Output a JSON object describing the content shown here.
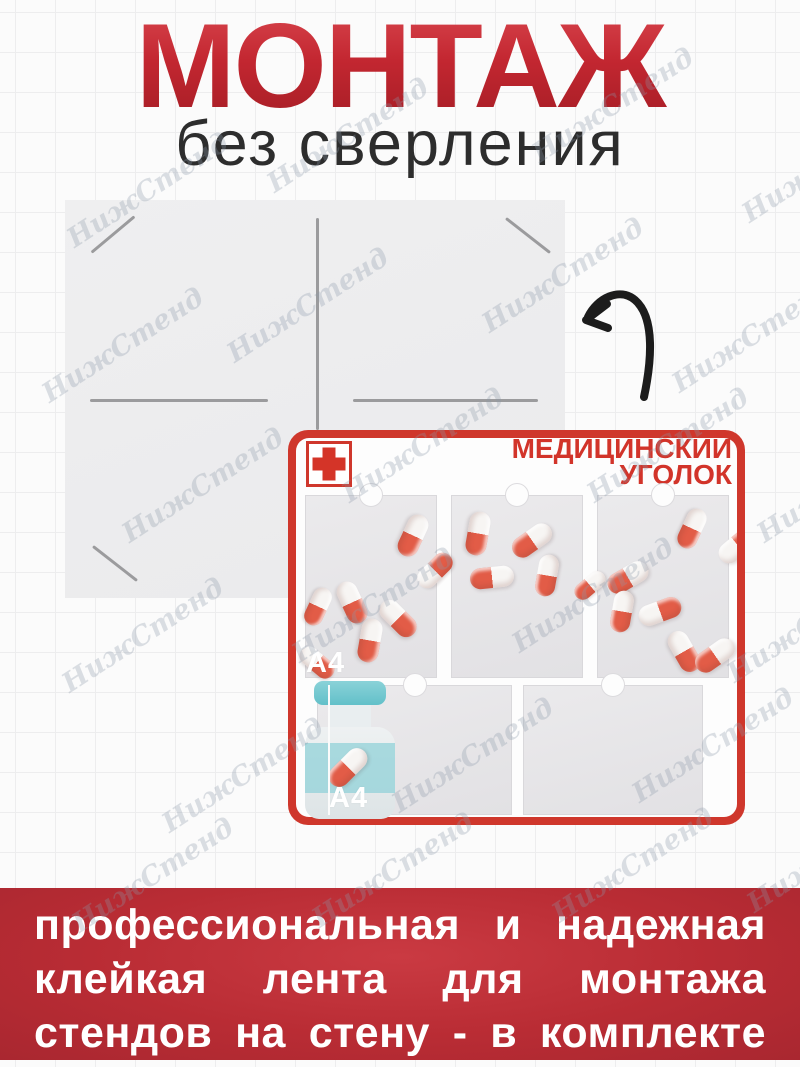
{
  "title": {
    "main": "МОНТАЖ",
    "subtitle": "без сверления"
  },
  "panel": {
    "tape_color": "#9b9b9d"
  },
  "icons": {
    "arrow": "curved-arrow",
    "cross": "red-cross-icon",
    "bottle": "medicine-bottle-icon",
    "pill": "capsule-icon"
  },
  "stand": {
    "title_line1": "МЕДИЦИНСКИЙ",
    "title_line2": "УГОЛОК",
    "pocket_label_top": "A4",
    "pocket_label_bottom": "A4",
    "accent": "#cf372c",
    "pill_red": "#e25c47",
    "pills": [
      {
        "x": 125,
        "y": 105,
        "r": 115,
        "flip": false,
        "s": 1
      },
      {
        "x": 64,
        "y": 172,
        "r": 65,
        "flip": false,
        "s": 1
      },
      {
        "x": 30,
        "y": 176,
        "r": 115,
        "flip": false,
        "s": 0.9
      },
      {
        "x": 110,
        "y": 188,
        "r": 45,
        "flip": false,
        "s": 1
      },
      {
        "x": 147,
        "y": 140,
        "r": -45,
        "flip": false,
        "s": 0.95
      },
      {
        "x": 82,
        "y": 210,
        "r": 100,
        "flip": false,
        "s": 1
      },
      {
        "x": 29,
        "y": 232,
        "r": 40,
        "flip": false,
        "s": 0.9
      },
      {
        "x": 190,
        "y": 103,
        "r": 100,
        "flip": false,
        "s": 1
      },
      {
        "x": 244,
        "y": 110,
        "r": -35,
        "flip": true,
        "s": 1
      },
      {
        "x": 204,
        "y": 147,
        "r": -6,
        "flip": true,
        "s": 1
      },
      {
        "x": 259,
        "y": 145,
        "r": -80,
        "flip": true,
        "s": 0.95
      },
      {
        "x": 302,
        "y": 155,
        "r": -40,
        "flip": true,
        "s": 0.8
      },
      {
        "x": 340,
        "y": 147,
        "r": -30,
        "flip": true,
        "s": 1
      },
      {
        "x": 334,
        "y": 181,
        "r": -80,
        "flip": true,
        "s": 0.95
      },
      {
        "x": 372,
        "y": 181,
        "r": -20,
        "flip": false,
        "s": 1
      },
      {
        "x": 396,
        "y": 221,
        "r": 60,
        "flip": false,
        "s": 1
      },
      {
        "x": 427,
        "y": 225,
        "r": -35,
        "flip": true,
        "s": 1
      },
      {
        "x": 404,
        "y": 98,
        "r": 115,
        "flip": false,
        "s": 0.95
      },
      {
        "x": 450,
        "y": 115,
        "r": -40,
        "flip": false,
        "s": 1
      }
    ]
  },
  "banner": {
    "bg": "#b92c34",
    "lines": [
      "профессиональная и надежная",
      "клейкая лента для монтажа",
      "стендов на стену - в комплекте"
    ]
  },
  "watermark": {
    "text": "НижСтенд",
    "color": "rgba(140,152,168,0.30)",
    "positions": [
      [
        55,
        175
      ],
      [
        255,
        120
      ],
      [
        520,
        90
      ],
      [
        730,
        150
      ],
      [
        30,
        330
      ],
      [
        215,
        290
      ],
      [
        470,
        260
      ],
      [
        660,
        320
      ],
      [
        110,
        470
      ],
      [
        330,
        430
      ],
      [
        575,
        430
      ],
      [
        745,
        470
      ],
      [
        50,
        620
      ],
      [
        280,
        590
      ],
      [
        500,
        580
      ],
      [
        715,
        610
      ],
      [
        150,
        760
      ],
      [
        380,
        740
      ],
      [
        620,
        730
      ],
      [
        60,
        860
      ],
      [
        300,
        855
      ],
      [
        540,
        850
      ],
      [
        735,
        840
      ]
    ]
  }
}
